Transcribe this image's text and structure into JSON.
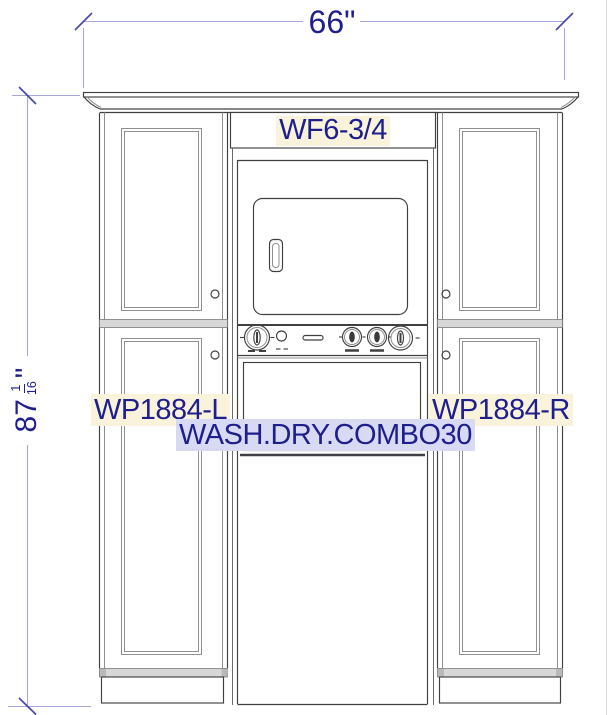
{
  "colors": {
    "dim_line": "#a8a8da",
    "dim_tick": "#4747b2",
    "annotation_text": "#1e1e8c",
    "highlight_cream": "#faf3dc",
    "highlight_lavender": "#d8daf4",
    "drawing_line": "#404040",
    "drawing_line_light": "#8f8f8f",
    "rail_fill": "#d7d7d7",
    "canvas_bg": "#ffffff",
    "view_border": "#d9d9d9"
  },
  "dimensions": {
    "width_label": "66\"",
    "height_whole": "87",
    "height_frac_num": "1",
    "height_frac_den": "16",
    "height_unit": "\""
  },
  "components": {
    "top_filler": "WF6-3/4",
    "left_pantry": "WP1884-L",
    "right_pantry": "WP1884-R",
    "washer_dryer": "WASH.DRY.COMBO30"
  }
}
